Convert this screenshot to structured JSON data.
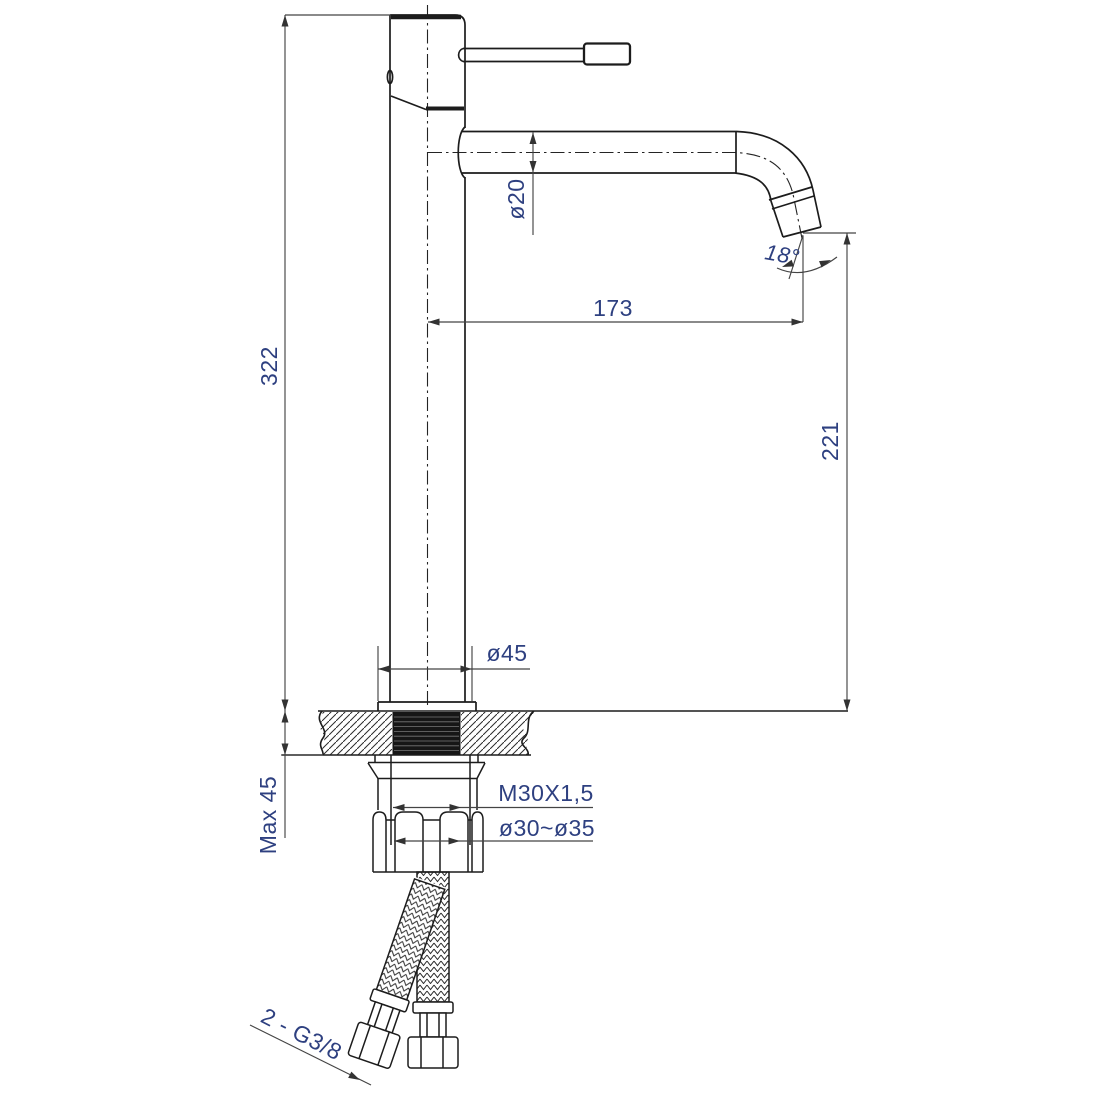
{
  "drawing": {
    "type": "technical-dimension-drawing",
    "subject": "Tall single-lever basin mixer faucet, side elevation with deck-mounting cross-section",
    "background": "#ffffff",
    "outline_color": "#1c1c1c",
    "dimension_line_color": "#444444",
    "dimension_text_color": "#2e4080",
    "dimensions": {
      "total_height": {
        "label": "322"
      },
      "spout_diameter": {
        "label": "ø20"
      },
      "spout_reach": {
        "label": "173"
      },
      "spout_angle": {
        "label": "18°"
      },
      "outlet_height": {
        "label": "221"
      },
      "base_diameter": {
        "label": "ø45"
      },
      "max_deck_thickness": {
        "label": "Max 45"
      },
      "thread_spec": {
        "label": "M30X1,5"
      },
      "hole_diameter": {
        "label": "ø30~ø35"
      },
      "hose_connection": {
        "label": "2 - G3/8"
      }
    }
  }
}
